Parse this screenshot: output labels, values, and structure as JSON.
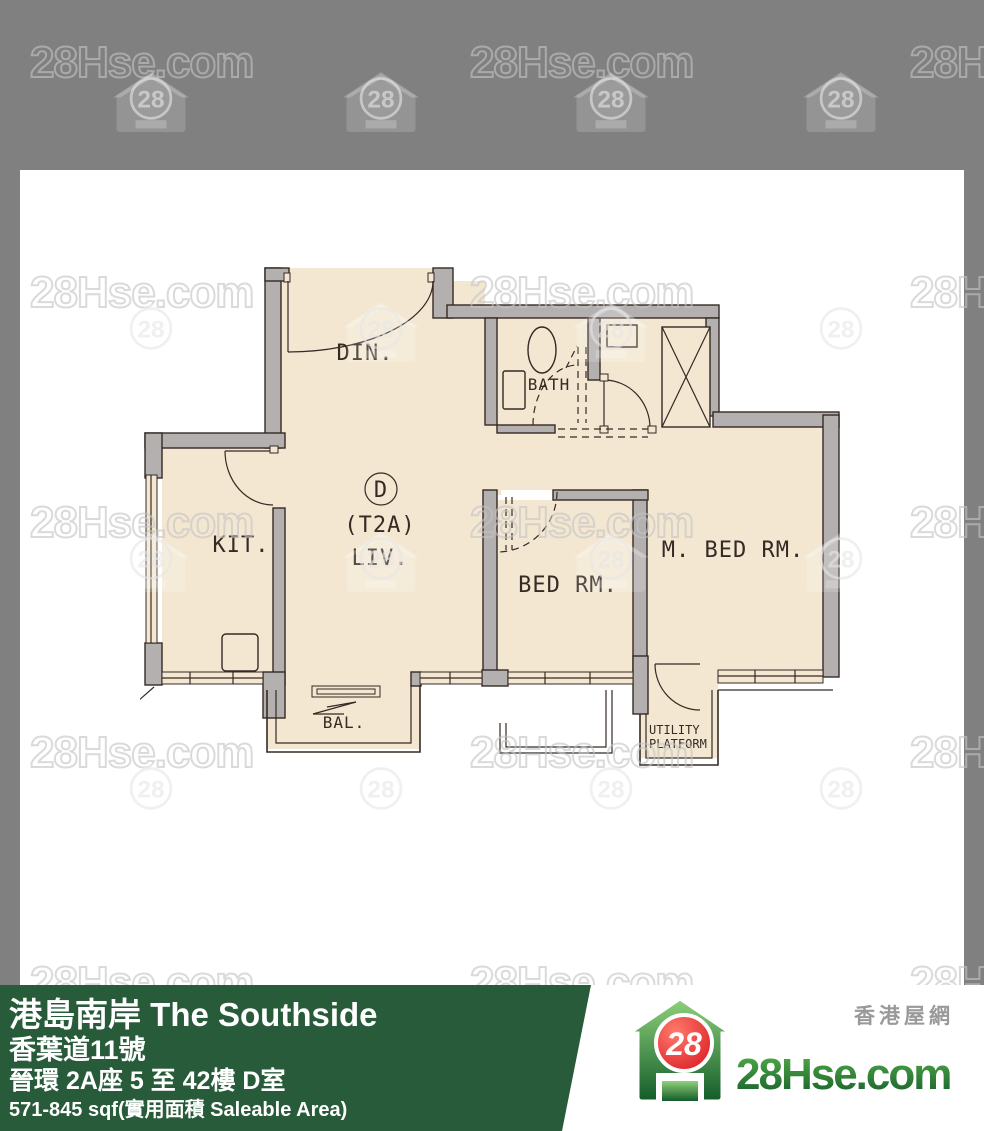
{
  "colors": {
    "background": "#808080",
    "panel": "#ffffff",
    "floor": "#f3e7d2",
    "wall": "#b3b0af",
    "line": "#352a24",
    "banner_green": "#275b39",
    "logo_red": "#d8161f",
    "logo_green_dark": "#135c2a",
    "logo_green_light": "#57b04a",
    "tagline_gray": "#999999"
  },
  "watermark": {
    "text": "28Hse.com",
    "badge": "28"
  },
  "floorplan": {
    "unit_label": "D",
    "unit_type": "(T2A)",
    "rooms": {
      "dining": "DIN.",
      "bath": "BATH",
      "kitchen": "KIT.",
      "living": "LIV.",
      "bedroom": "BED RM.",
      "master_bedroom": "M. BED RM.",
      "balcony": "BAL.",
      "utility_line1": "UTILITY",
      "utility_line2": "PLATFORM"
    }
  },
  "banner": {
    "title": "港島南岸 The Southside",
    "address": "香葉道11號",
    "unit_info": "晉環 2A座 5 至 42樓 D室",
    "area": "571-845 sqf(實用面積 Saleable Area)"
  },
  "logo": {
    "badge": "28",
    "name": "28Hse.com",
    "tagline": "香港屋網"
  }
}
